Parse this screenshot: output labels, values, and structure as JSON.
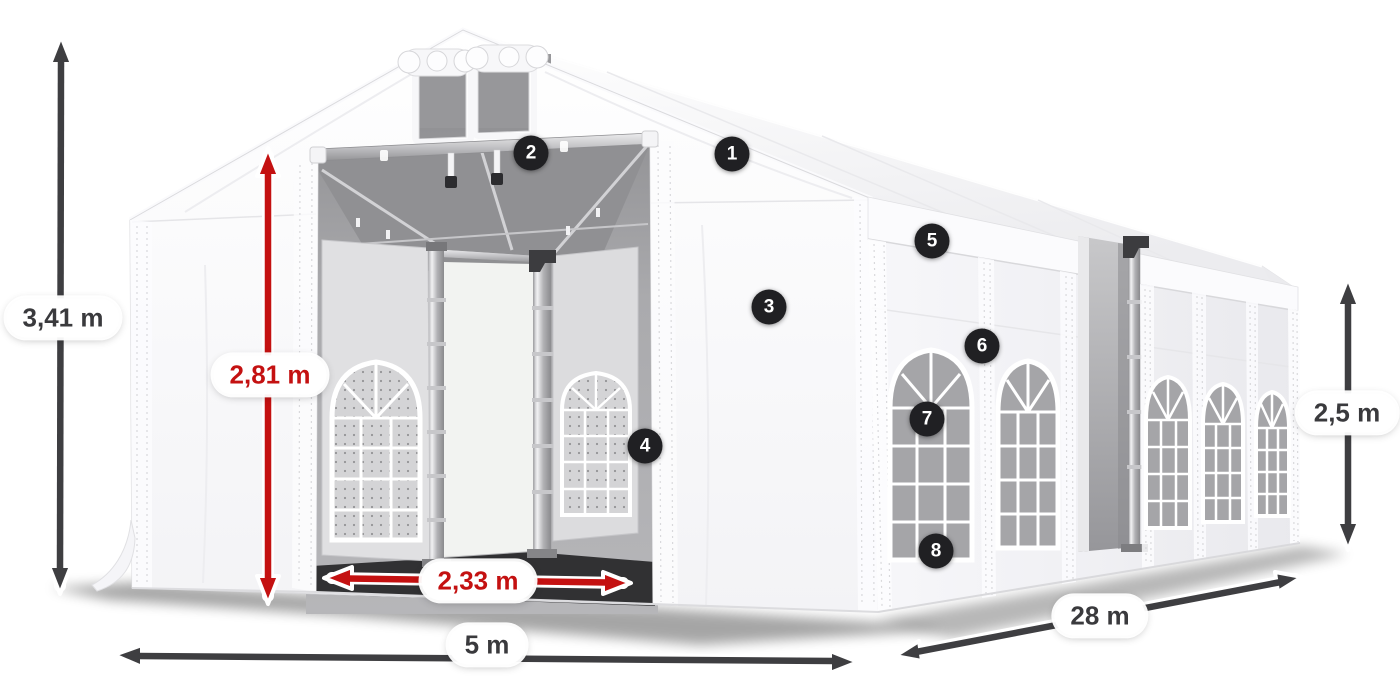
{
  "diagram": {
    "subject": "Party tent with dimension annotations",
    "view": "3D product illustration"
  },
  "dimensions": {
    "total_height": "3,41 m",
    "entrance_height": "2,81 m",
    "entrance_width": "2,33 m",
    "front_width": "5 m",
    "length": "28 m",
    "side_wall_height": "2,5 m"
  },
  "callouts": [
    {
      "number": "1"
    },
    {
      "number": "2"
    },
    {
      "number": "3"
    },
    {
      "number": "4"
    },
    {
      "number": "5"
    },
    {
      "number": "6"
    },
    {
      "number": "7"
    },
    {
      "number": "8"
    }
  ],
  "colors": {
    "dimension_arrow_red": "#c41111",
    "dimension_arrow_gray": "#3e3e41",
    "callout_background": "#202023",
    "callout_text": "#ffffff",
    "label_background": "#ffffff",
    "label_text": "#3a3a3d",
    "tent_fabric": "#ffffff"
  }
}
